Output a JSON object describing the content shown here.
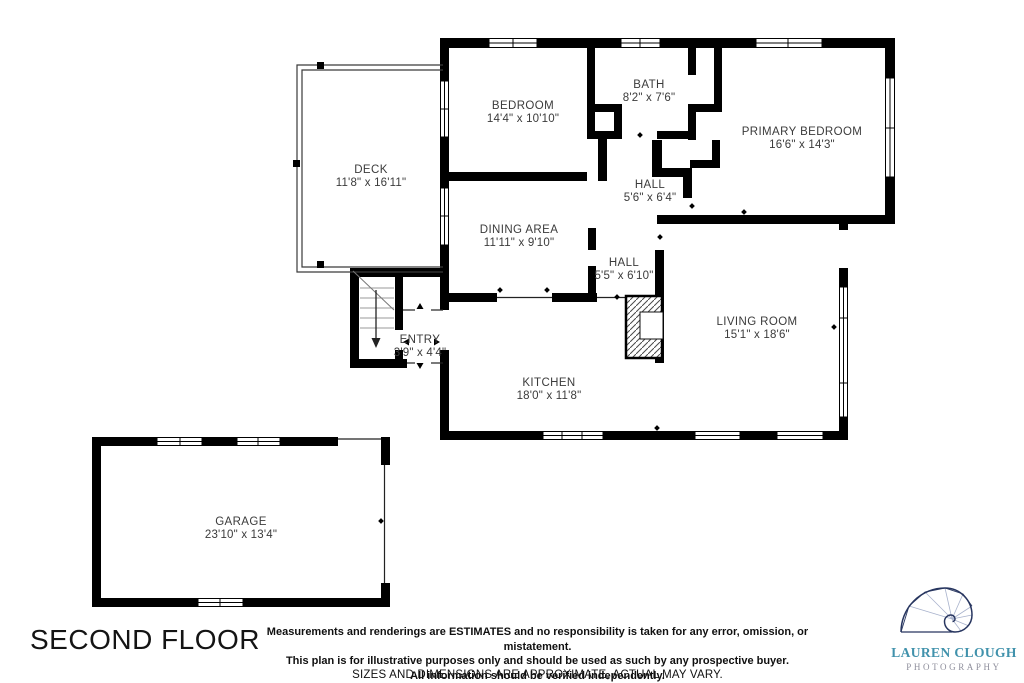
{
  "floor_plan": {
    "title": "SECOND FLOOR",
    "rooms": [
      {
        "name": "DECK",
        "dims": "11'8\" x 16'11\"",
        "x": 371,
        "y": 164
      },
      {
        "name": "BEDROOM",
        "dims": "14'4\" x 10'10\"",
        "x": 523,
        "y": 100
      },
      {
        "name": "BATH",
        "dims": "8'2\" x 7'6\"",
        "x": 649,
        "y": 79
      },
      {
        "name": "PRIMARY BEDROOM",
        "dims": "16'6\" x 14'3\"",
        "x": 802,
        "y": 126
      },
      {
        "name": "HALL",
        "dims": "5'6\" x 6'4\"",
        "x": 650,
        "y": 179
      },
      {
        "name": "DINING AREA",
        "dims": "11'11\" x 9'10\"",
        "x": 519,
        "y": 224
      },
      {
        "name": "HALL",
        "dims": "5'5\" x 6'10\"",
        "x": 624,
        "y": 257
      },
      {
        "name": "ENTRY",
        "dims": "3'9\" x 4'4\"",
        "x": 420,
        "y": 334
      },
      {
        "name": "LIVING ROOM",
        "dims": "15'1\" x 18'6\"",
        "x": 757,
        "y": 316
      },
      {
        "name": "KITCHEN",
        "dims": "18'0\" x 11'8\"",
        "x": 549,
        "y": 377
      },
      {
        "name": "GARAGE",
        "dims": "23'10\" x 13'4\"",
        "x": 241,
        "y": 516
      }
    ],
    "disclaimer": {
      "line1": "Measurements and renderings are ESTIMATES and no responsibility is taken for any error, omission, or mistatement.",
      "line2": "This plan is for illustrative purposes only and should be used as such by any prospective buyer.",
      "line3": "All information should be verified independently."
    },
    "footer_note": "SIZES AND DIMENSIONS ARE APPROXIMATE, ACTUAL MAY VARY.",
    "logo": {
      "name": "LAUREN CLOUGH",
      "subtitle": "PHOTOGRAPHY",
      "name_color": "#4192ac",
      "subtitle_color": "#8f8f9c",
      "spiral_color": "#27355f"
    },
    "colors": {
      "wall": "#000000",
      "label": "#3b3b3b",
      "background": "#ffffff"
    }
  }
}
